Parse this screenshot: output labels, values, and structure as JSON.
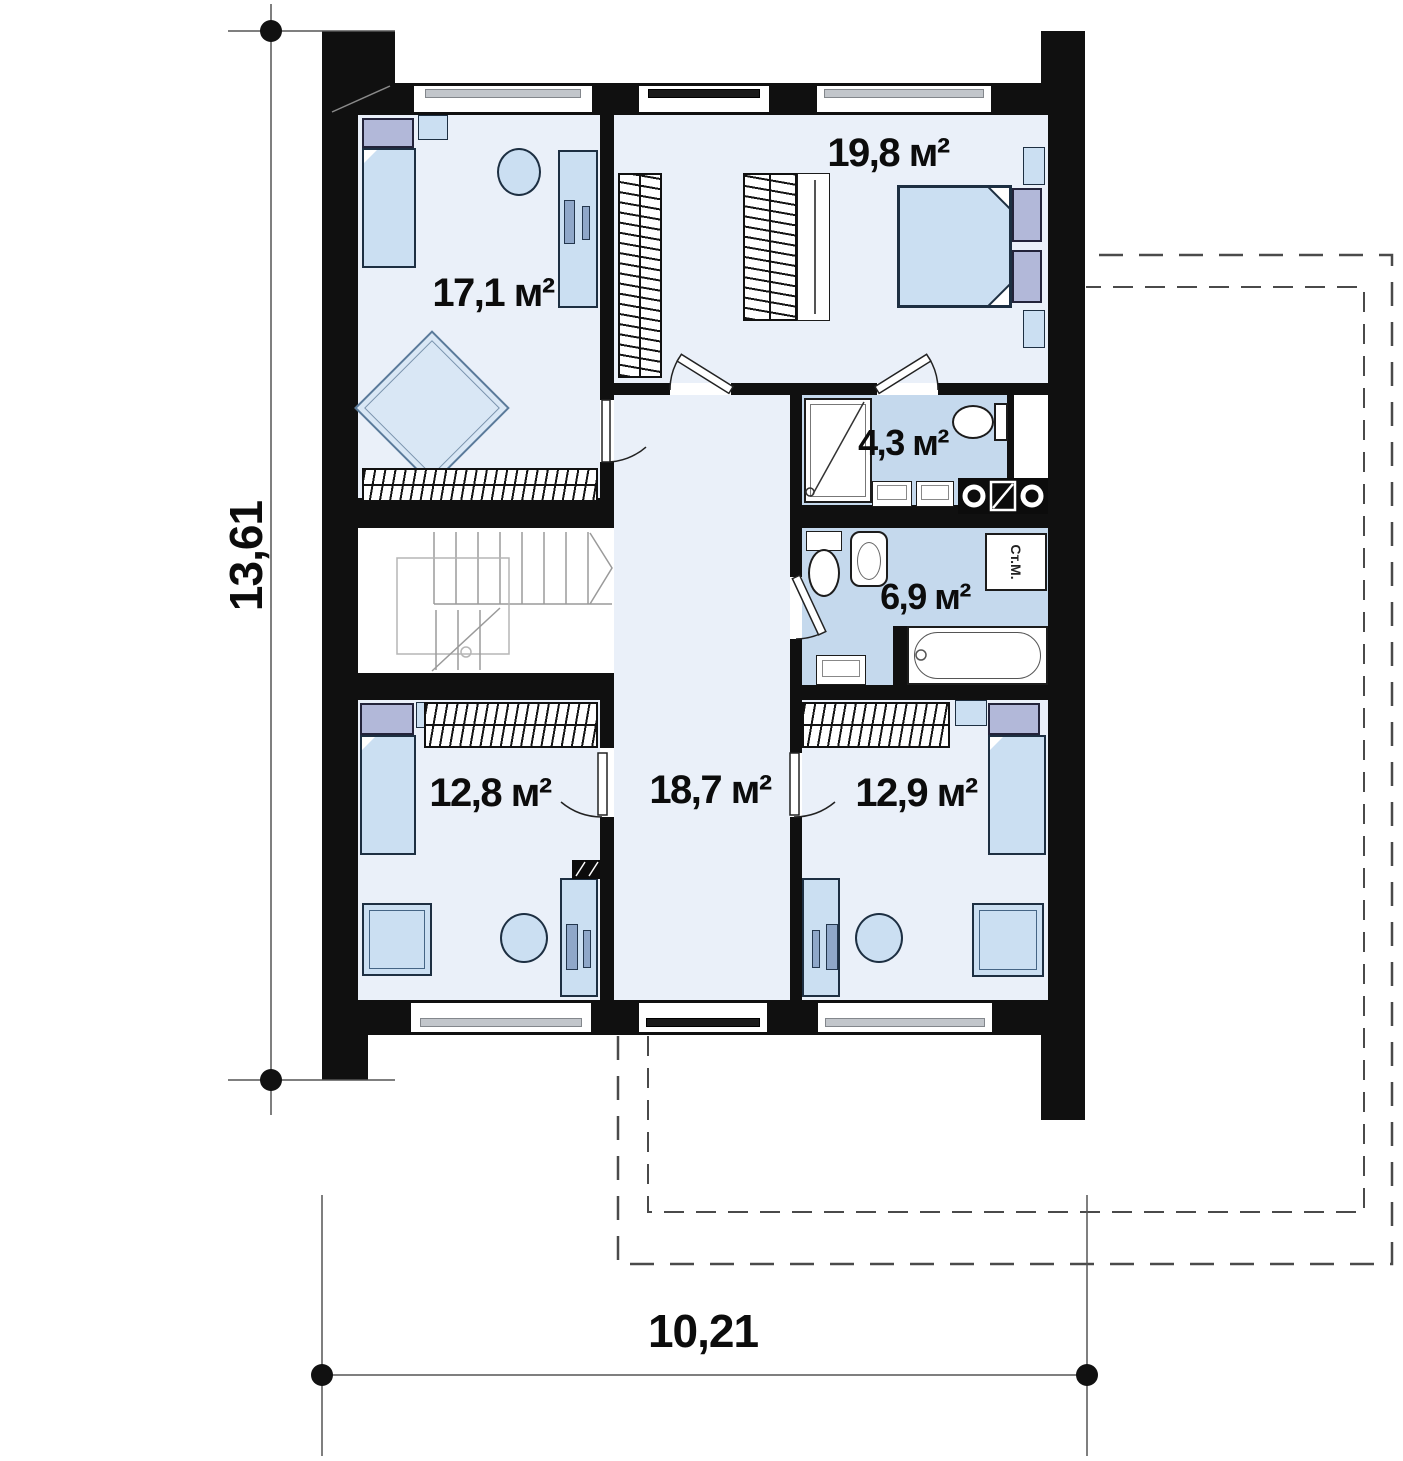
{
  "rooms": [
    {
      "key": "bedroom-top-left",
      "area": "17,1 м²"
    },
    {
      "key": "bedroom-top-right",
      "area": "19,8 м²"
    },
    {
      "key": "bathroom-ensuite",
      "area": "4,3 м²"
    },
    {
      "key": "bathroom-family",
      "area": "6,9 м²"
    },
    {
      "key": "bedroom-bottom-left",
      "area": "12,8 м²"
    },
    {
      "key": "hall",
      "area": "18,7 м²"
    },
    {
      "key": "bedroom-bottom-right",
      "area": "12,9 м²"
    }
  ],
  "dimensions": {
    "vertical": "13,61",
    "horizontal": "10,21"
  },
  "appliance_labels": {
    "washing_machine": "Ст.М."
  },
  "colors": {
    "wall": "#101010",
    "room_fill": "#eaf0f9",
    "bath_fill": "#c5d9ed",
    "furniture_fill": "#cbdff2",
    "pillow_fill": "#b2b8d9",
    "stairs_fill": "#ffffff",
    "dashed_outline": "#4a4a4a"
  }
}
